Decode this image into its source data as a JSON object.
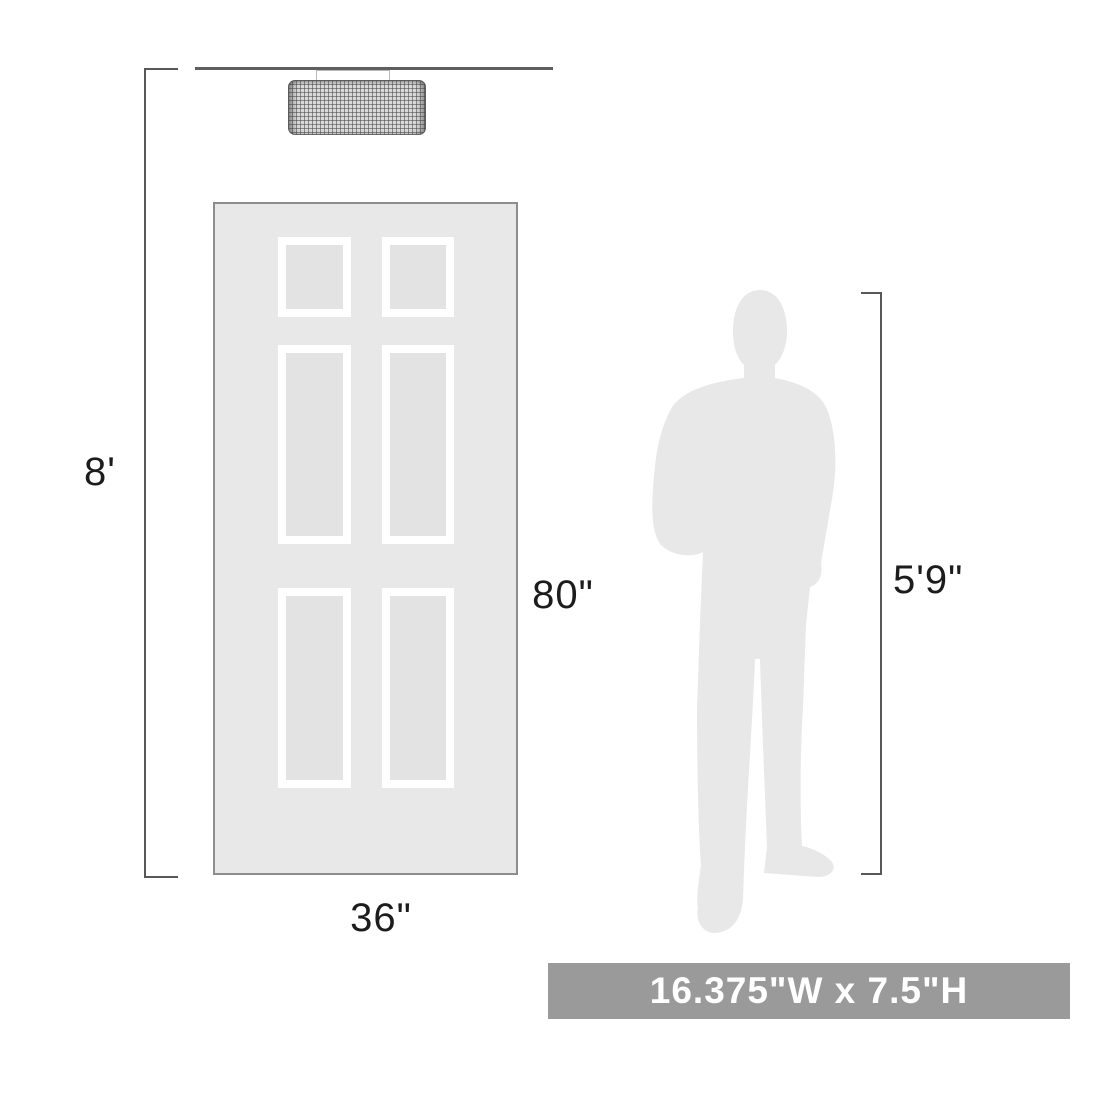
{
  "dimensions": {
    "ceiling_height": "8'",
    "door_height": "80\"",
    "door_width": "36\"",
    "person_height": "5'9\"",
    "fixture_size": "16.375\"W x 7.5\"H"
  },
  "figures": {
    "fixture": "flush-mount-drum-light-fixture",
    "door": "six-panel-door",
    "person": "man-silhouette"
  },
  "colors": {
    "ceiling_line": "#5f5f5f",
    "dimension_line": "#585858",
    "label_text": "#1c1c1c",
    "door_fill": "#e8e8e8",
    "door_border": "#8d8d8d",
    "panel_frame": "#ffffff",
    "panel_fill": "#e3e3e3",
    "silhouette_fill": "#e8e8e8",
    "banner_bg": "#9a9a9a",
    "banner_text": "#ffffff",
    "shade_fill": "#d9d9d9",
    "shade_line": "#6a6a6a",
    "canopy_fill": "#ffffff",
    "canopy_border": "#b9b9b9"
  }
}
